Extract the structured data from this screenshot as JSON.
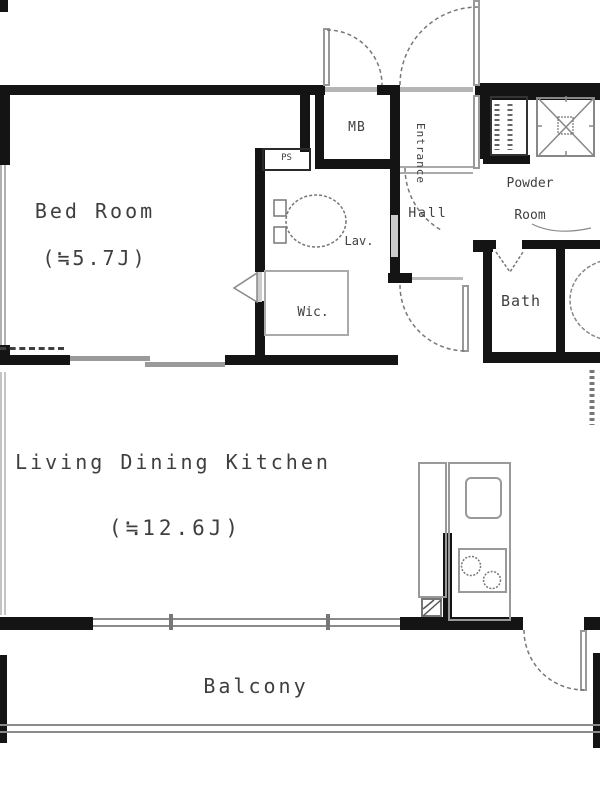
{
  "rooms": {
    "bed_room": {
      "name": "Bed Room",
      "size": "(≒5.7J)"
    },
    "ldk": {
      "name": "Living Dining Kitchen",
      "size": "(≒12.6J)"
    },
    "balcony": {
      "name": "Balcony"
    },
    "bath": {
      "name": "Bath"
    },
    "powder_room": {
      "name": "Powder Room"
    },
    "lavatory": {
      "name": "Lav."
    },
    "walk_in_closet": {
      "name": "Wic."
    },
    "hall": {
      "name": "Hall"
    },
    "entrance": {
      "name": "Entrance"
    },
    "meter_box": {
      "name": "MB"
    },
    "pipe_space": {
      "name": "PS"
    }
  },
  "colors": {
    "wall": "#141414",
    "fixture_gray": "#8a8a8a",
    "label_text": "#3f3f3f",
    "background": "#ffffff"
  }
}
